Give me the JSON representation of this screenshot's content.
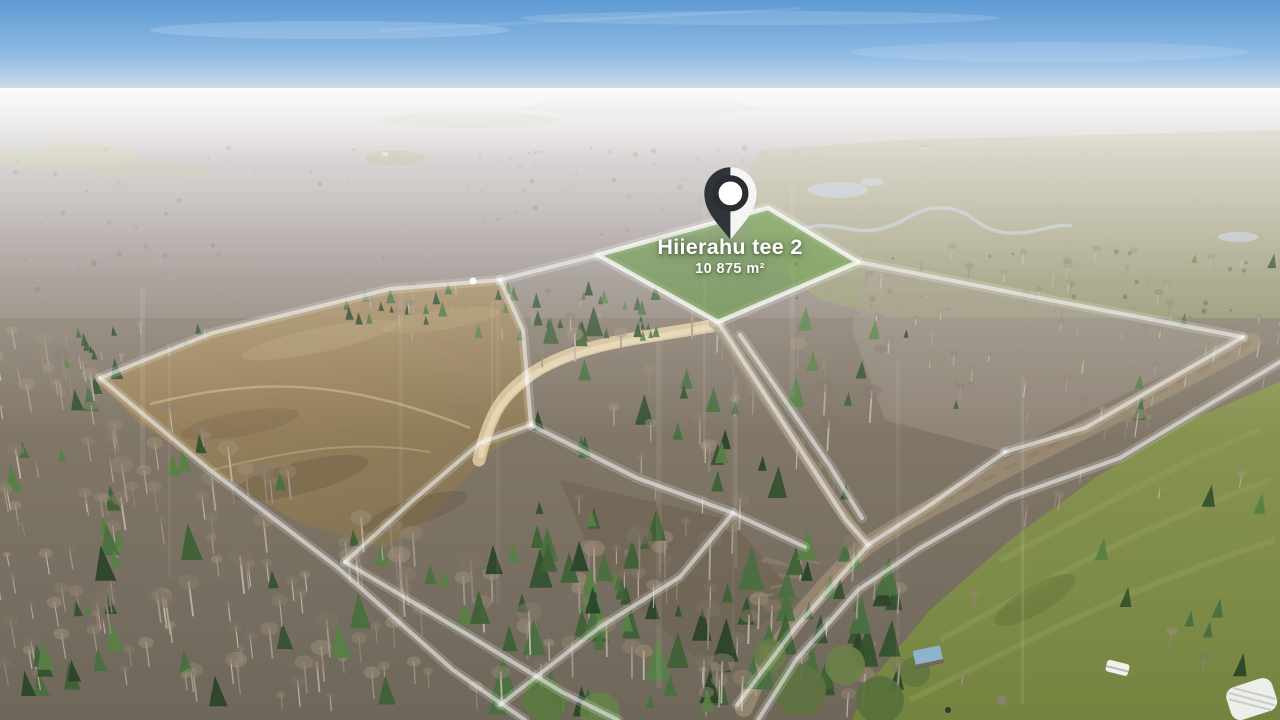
{
  "scene": {
    "description": "Aerial drone photo of a forest land development with surveyed plot boundaries",
    "season_look": "late autumn, hazy horizon"
  },
  "marker": {
    "label": "Hiierahu tee 2",
    "area": "10 875 m²"
  },
  "palette": {
    "sky": "#6ea6da",
    "haze": "#e9e8e6",
    "distant_forest": "#9a9095",
    "field": "#97805c",
    "forest_floor": "#77705f",
    "meadow": "#7f8c4a",
    "road": "#d8c49c",
    "mud_road": "#9c8c74",
    "parcel_highlight": "#68a046",
    "boundary_line": "#ffffff",
    "pin_dark": "#2f343a",
    "pin_light": "#f5f5f3",
    "water": "#b6bec4",
    "tarp_blue": "#8fb3cc"
  }
}
